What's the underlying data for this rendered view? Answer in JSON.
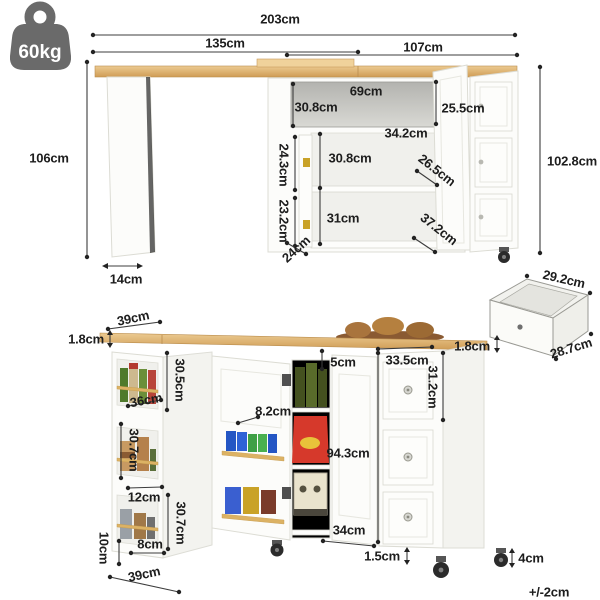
{
  "weight_badge": {
    "label": "60kg"
  },
  "tolerance_note": "+/-2cm",
  "top_view": {
    "total_width": "203cm",
    "left_section_width": "135cm",
    "right_section_width": "107cm",
    "overall_height": "106cm",
    "leg_depth": "14cm",
    "niche_width": "69cm",
    "niche_height_left": "30.8cm",
    "niche_height_right": "25.5cm",
    "niche_depth": "34.2cm",
    "upper_shelf_height": "30.8cm",
    "lower_shelf_height": "31cm",
    "upper_door_depth": "24.3cm",
    "lower_door_depth": "23.2cm",
    "upper_door_width": "26.5cm",
    "lower_door_width": "37.2cm",
    "base_depth": "24cm",
    "cabinet_height": "102.8cm"
  },
  "drawer_detail": {
    "width": "29.2cm",
    "depth": "28.7cm"
  },
  "folded_view": {
    "side_top_width": "39cm",
    "counter_thickness_left": "1.8cm",
    "counter_thickness_right": "1.8cm",
    "side_upper_height": "30.5cm",
    "side_shelf_width": "36cm",
    "side_middle_height": "30.7cm",
    "side_lower_opening": "12cm",
    "side_lower_height": "30.7cm",
    "side_rail_gap": "8cm",
    "base_height": "10cm",
    "base_depth": "39cm",
    "top_clearance": "5cm",
    "door_rack_depth": "8.2cm",
    "body_height": "94.3cm",
    "door_width": "34cm",
    "bottom_clearance": "1.5cm",
    "drawer_front_width": "33.5cm",
    "drawer_front_height": "31.2cm",
    "caster_height": "4cm"
  }
}
